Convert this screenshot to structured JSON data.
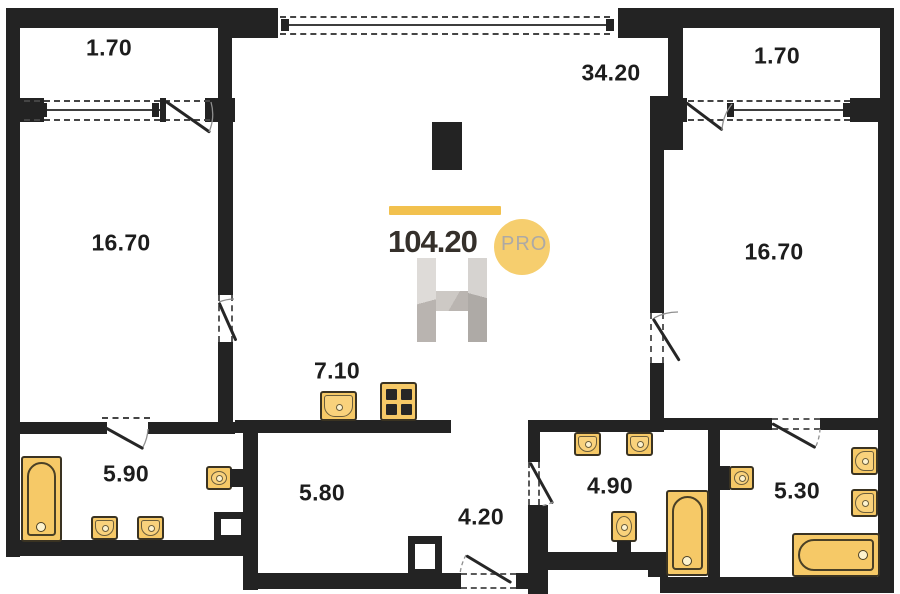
{
  "plan": {
    "labels": {
      "balcony_left": "1.70",
      "living": "34.20",
      "balcony_right": "1.70",
      "bedroom_left": "16.70",
      "bedroom_right": "16.70",
      "kitchen": "7.10",
      "bath_left": "5.90",
      "hall": "5.80",
      "entry": "4.20",
      "bath_mid": "4.90",
      "bath_right": "5.30"
    }
  },
  "watermark": {
    "total_area": "104.20",
    "brand_suffix": "PRO"
  },
  "colors": {
    "wall": "#232323",
    "fixture_fill": "#F6C967",
    "accent_bar": "#F2C14E",
    "accent_circle": "#F6CE6E",
    "brand_text": "#35302B",
    "brand_suffix_text": "#ADA9A5"
  }
}
